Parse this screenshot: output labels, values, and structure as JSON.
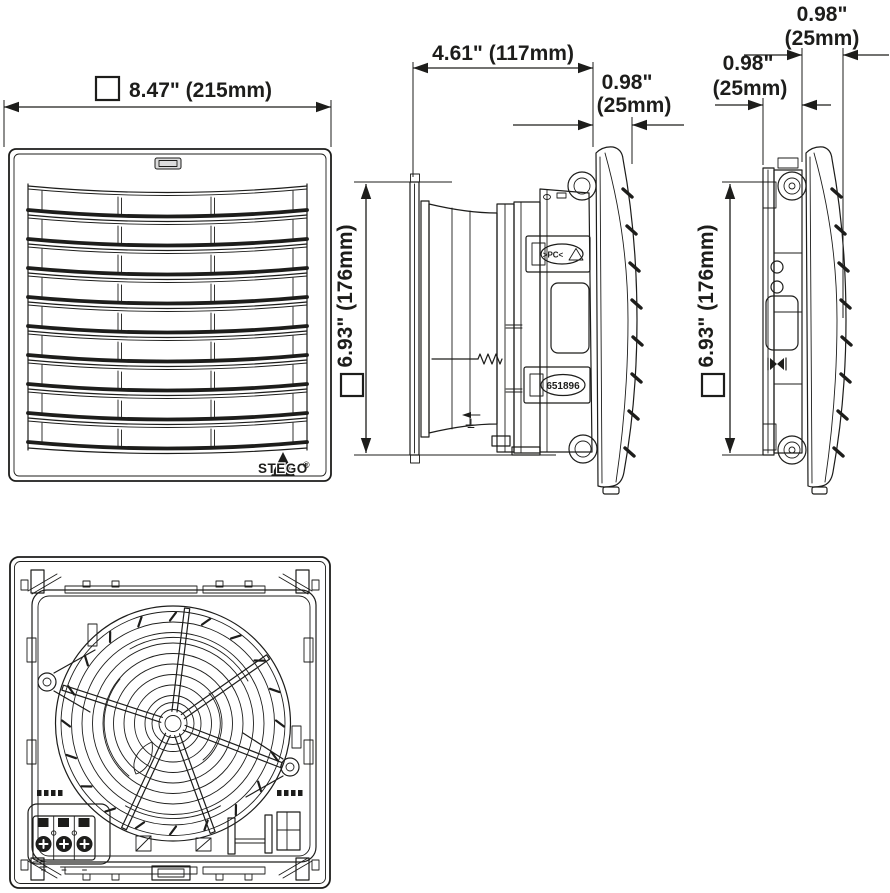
{
  "colors": {
    "line": "#1d1d1b",
    "background": "#ffffff",
    "clip_gray": "#dcdcdc"
  },
  "dimensions": {
    "front_width": "8.47\" (215mm)",
    "front_height": "6.93\" (176mm)",
    "side_depth": "4.61\" (117mm)",
    "side_cover_in": "0.98\"",
    "side_cover_mm": "(25mm)",
    "exhaust_plate_in": "0.98\"",
    "exhaust_plate_mm": "(25mm)",
    "exhaust_cover_in": "0.98\"",
    "exhaust_cover_mm": "(25mm)",
    "exhaust_height": "6.93\" (176mm)"
  },
  "labels": {
    "brand": "STEGO",
    "registered": "®",
    "part_number": "651896",
    "material": ">PC<"
  }
}
